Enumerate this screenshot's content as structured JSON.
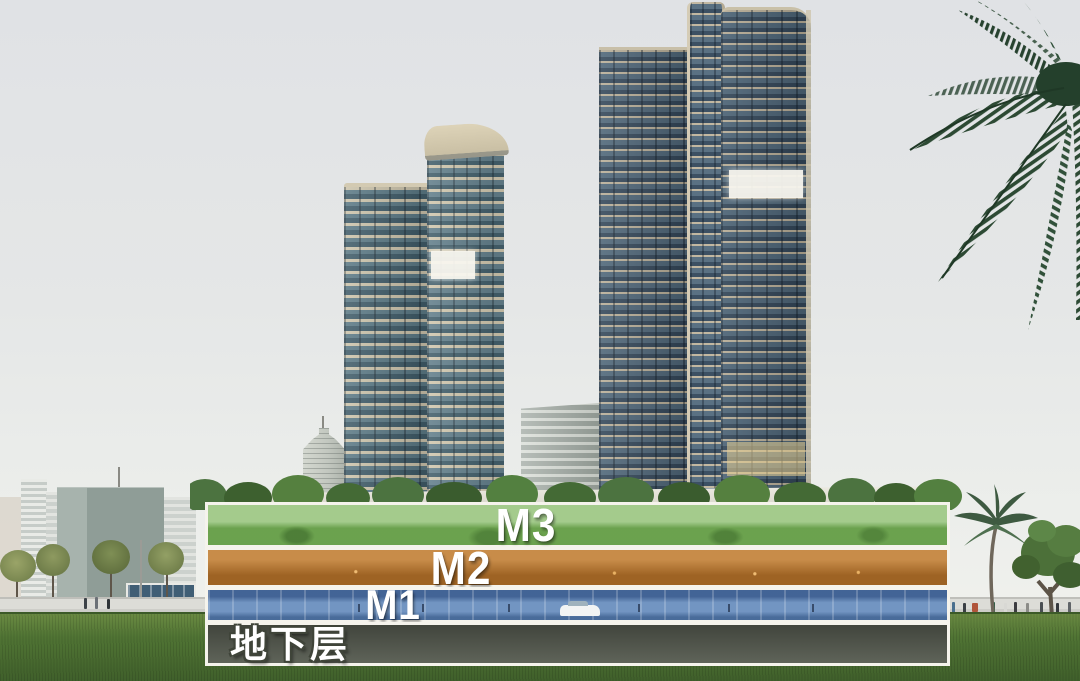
{
  "annotation": {
    "label_color": "#ffffff",
    "band_border_color": "#f5f3ec",
    "bands": [
      {
        "id": "m3",
        "label": "M3",
        "fill": "#7cb55b"
      },
      {
        "id": "m2",
        "label": "M2",
        "fill": "#c07c30"
      },
      {
        "id": "m1",
        "label": "M1",
        "fill": "#5b84b8"
      },
      {
        "id": "basement",
        "label": "地下层",
        "fill": "#565b50"
      }
    ]
  },
  "palette": {
    "sky_top": "#e0e2e5",
    "sky_bottom": "#f2f2ee",
    "grass": "#4e7233",
    "tower_glass": "#51707e",
    "tower_slab": "#cdc5ad",
    "palm_green": "#2d4a34",
    "street": "#d6d6d1"
  }
}
